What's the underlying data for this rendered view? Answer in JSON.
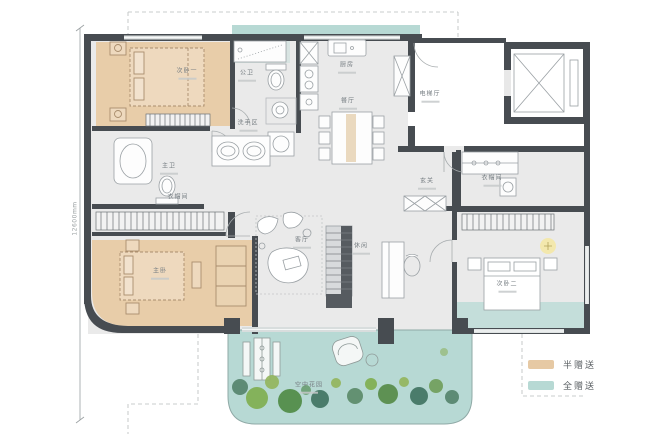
{
  "rooms": {
    "bedroom1": {
      "label": "次卧一"
    },
    "guest_bath": {
      "label": "公卫"
    },
    "wash_area": {
      "label": "洗手区"
    },
    "master_bath": {
      "label": "主卫"
    },
    "master_closet": {
      "label": "衣帽间"
    },
    "master_bedroom": {
      "label": "主卧"
    },
    "kitchen": {
      "label": "厨房"
    },
    "dining": {
      "label": "餐厅"
    },
    "elevator_hall": {
      "label": "电梯厅"
    },
    "foyer": {
      "label": "玄关"
    },
    "cloakroom": {
      "label": "衣帽间"
    },
    "bedroom2": {
      "label": "次卧二"
    },
    "living": {
      "label": "客厅"
    },
    "leisure": {
      "label": "休闲"
    },
    "sky_garden": {
      "label": "空中花园"
    }
  },
  "dimensions": {
    "left": "12600mm"
  },
  "legend": {
    "half": {
      "label": "半赠送",
      "color": "#e6c9a4"
    },
    "full": {
      "label": "全赠送",
      "color": "#b7d9d4"
    }
  },
  "colors": {
    "wall": "#474c51",
    "floor": "#eaeaea",
    "half_gift": "#e6c9a4",
    "full_gift": "#b7d9d4",
    "tree_green": "#6f9e5a",
    "lamp_glow": "#f3e8ad"
  }
}
